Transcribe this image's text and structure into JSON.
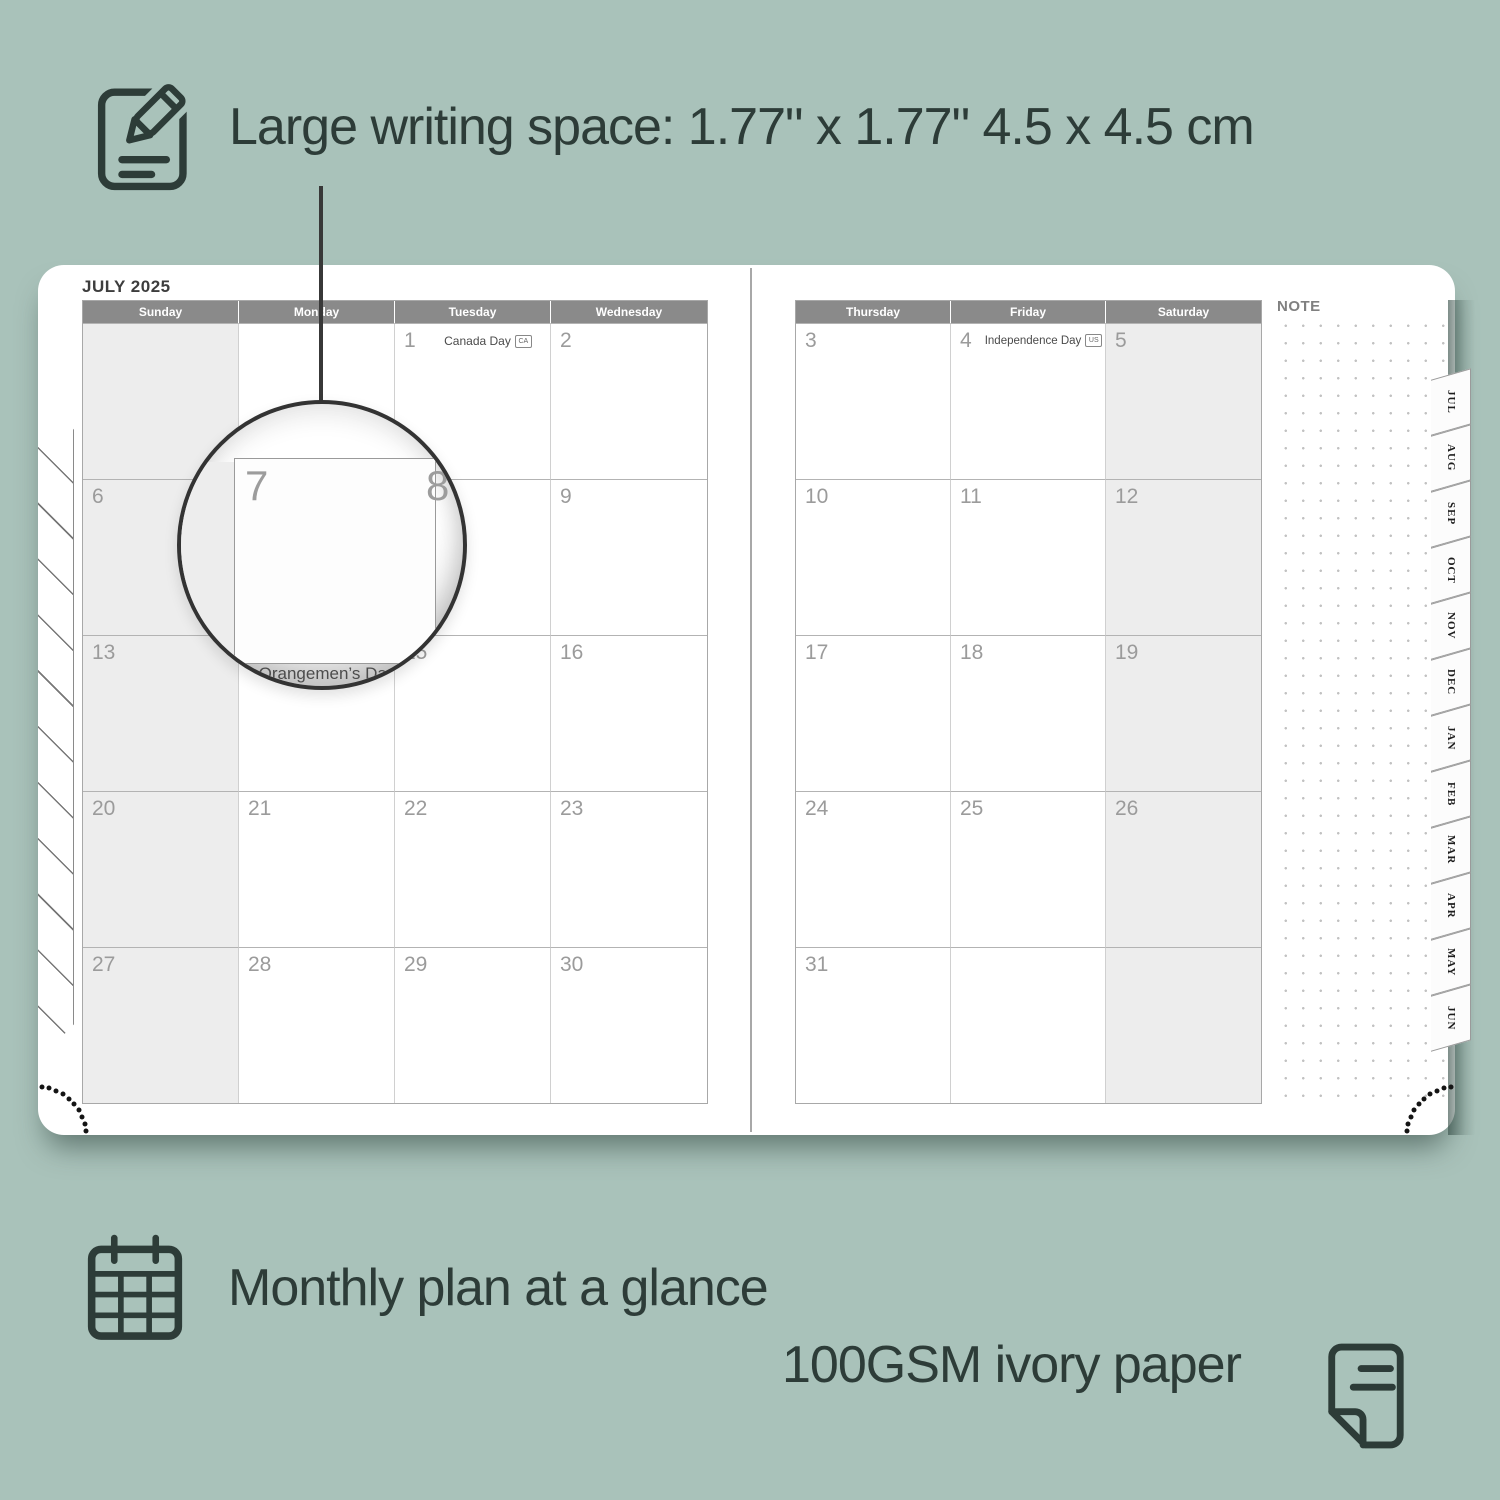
{
  "colors": {
    "background": "#a9c2ba",
    "ink": "#2d3c38",
    "header_bar": "#8a8a8a",
    "shaded_cell": "#ededed",
    "day_number": "#9b9b9b"
  },
  "features": {
    "writing_space": "Large writing space: 1.77\" x 1.77\" 4.5 x 4.5 cm",
    "monthly_plan": "Monthly plan at a glance",
    "paper": "100GSM ivory paper"
  },
  "planner": {
    "title": "JULY 2025",
    "note_label": "NOTE",
    "left_headers": [
      "Sunday",
      "Monday",
      "Tuesday",
      "Wednesday"
    ],
    "right_headers": [
      "Thursday",
      "Friday",
      "Saturday"
    ],
    "left_days": [
      [
        "",
        "",
        "1",
        "2"
      ],
      [
        "6",
        "7",
        "8",
        "9"
      ],
      [
        "13",
        "14",
        "15",
        "16"
      ],
      [
        "20",
        "21",
        "22",
        "23"
      ],
      [
        "27",
        "28",
        "29",
        "30"
      ]
    ],
    "right_days": [
      [
        "3",
        "4",
        "5"
      ],
      [
        "10",
        "11",
        "12"
      ],
      [
        "17",
        "18",
        "19"
      ],
      [
        "24",
        "25",
        "26"
      ],
      [
        "31",
        "",
        ""
      ]
    ],
    "holidays": {
      "canada_day": {
        "label": "Canada Day",
        "badge": "CA"
      },
      "independence_day": {
        "label": "Independence Day",
        "badge": "US"
      }
    },
    "tabs": [
      "JUL",
      "AUG",
      "SEP",
      "OCT",
      "NOV",
      "DEC",
      "JAN",
      "FEB",
      "MAR",
      "APR",
      "MAY",
      "JUN"
    ],
    "magnifier": {
      "day": "7",
      "next_day": "8",
      "below_day": "4",
      "holiday_line1": "Orangemen’s Day",
      "holiday_line2": "(N.L.)",
      "badge": "CA"
    }
  }
}
